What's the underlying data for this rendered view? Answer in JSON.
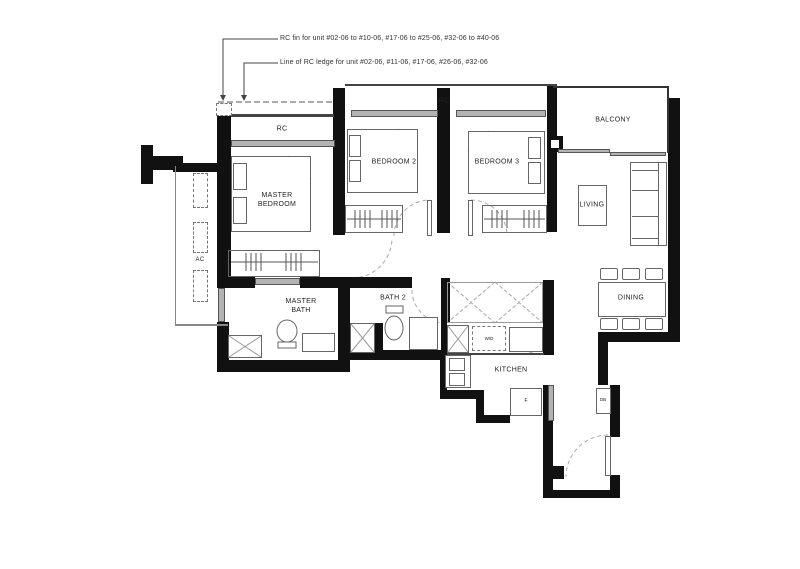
{
  "annotations": {
    "line1": "RC fin for unit #02-06 to #10-06, #17-06 to #25-06, #32-06 to #40-06",
    "line2": "Line of RC ledge for unit #02-06, #11-06, #17-06, #26-06, #32-06"
  },
  "labels": {
    "rc_master": "RC",
    "rc_upper": "RC",
    "balcony": "BALCONY",
    "master_bedroom": "MASTER BEDROOM",
    "bedroom2": "BEDROOM 2",
    "bedroom3": "BEDROOM 3",
    "living": "LIVING",
    "dining": "DINING",
    "kitchen": "KITCHEN",
    "master_bath": "MASTER BATH",
    "bath2": "BATH 2",
    "ac": "AC",
    "washer_dryer": "W/D",
    "fridge": "F",
    "db": "DB"
  },
  "colors": {
    "wall": "#111111",
    "thin_line": "#555555",
    "window_fill": "#b3b3b3",
    "dash_line": "#999999",
    "text": "#222222"
  }
}
